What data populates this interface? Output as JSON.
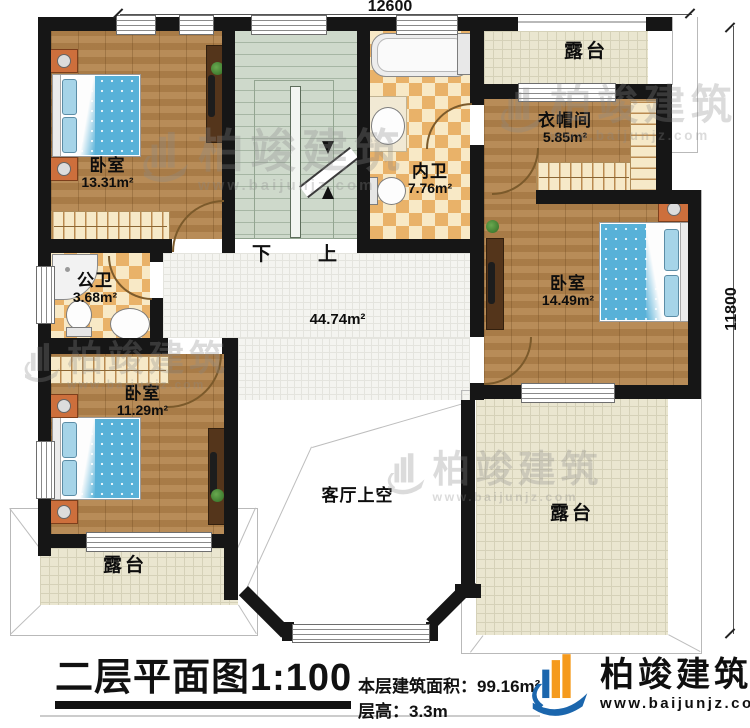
{
  "dimensions": {
    "top": "12600",
    "right": "11800"
  },
  "rooms": {
    "bedroom_tl": {
      "label": "卧室",
      "area": "13.31m²"
    },
    "bath_public": {
      "label": "公卫",
      "area": "3.68m²"
    },
    "bedroom_bl": {
      "label": "卧室",
      "area": "11.29m²"
    },
    "bath_ensuite": {
      "label": "内卫",
      "area": "7.76m²"
    },
    "cloakroom": {
      "label": "衣帽间",
      "area": "5.85m²"
    },
    "bedroom_r": {
      "label": "卧室",
      "area": "14.49m²"
    },
    "hall": {
      "area": "44.74m²"
    },
    "void": {
      "label": "客厅上空"
    },
    "terrace_top": {
      "label": "露台"
    },
    "terrace_bl": {
      "label": "露台"
    },
    "terrace_br": {
      "label": "露台"
    }
  },
  "stairs": {
    "down": "下",
    "up": "上"
  },
  "titleblock": {
    "title": "二层平面图1:100",
    "floor_area_label": "本层建筑面积：",
    "floor_area_value": "99.16m²",
    "floor_height_label": "层高：",
    "floor_height_value": "3.3m"
  },
  "brand": {
    "name": "柏竣建筑",
    "url": "www.baijunjz.com"
  },
  "watermark": {
    "name": "柏竣建筑",
    "url": "www.baijunjz.com"
  },
  "colors": {
    "wall": "#161616",
    "wood": "#b3834b",
    "tile_checker": "#e9b269",
    "stair": "#ced9cb",
    "bed": "#58b1d8",
    "brand_blue": "#1b66ad",
    "brand_orange": "#f59a1d"
  }
}
